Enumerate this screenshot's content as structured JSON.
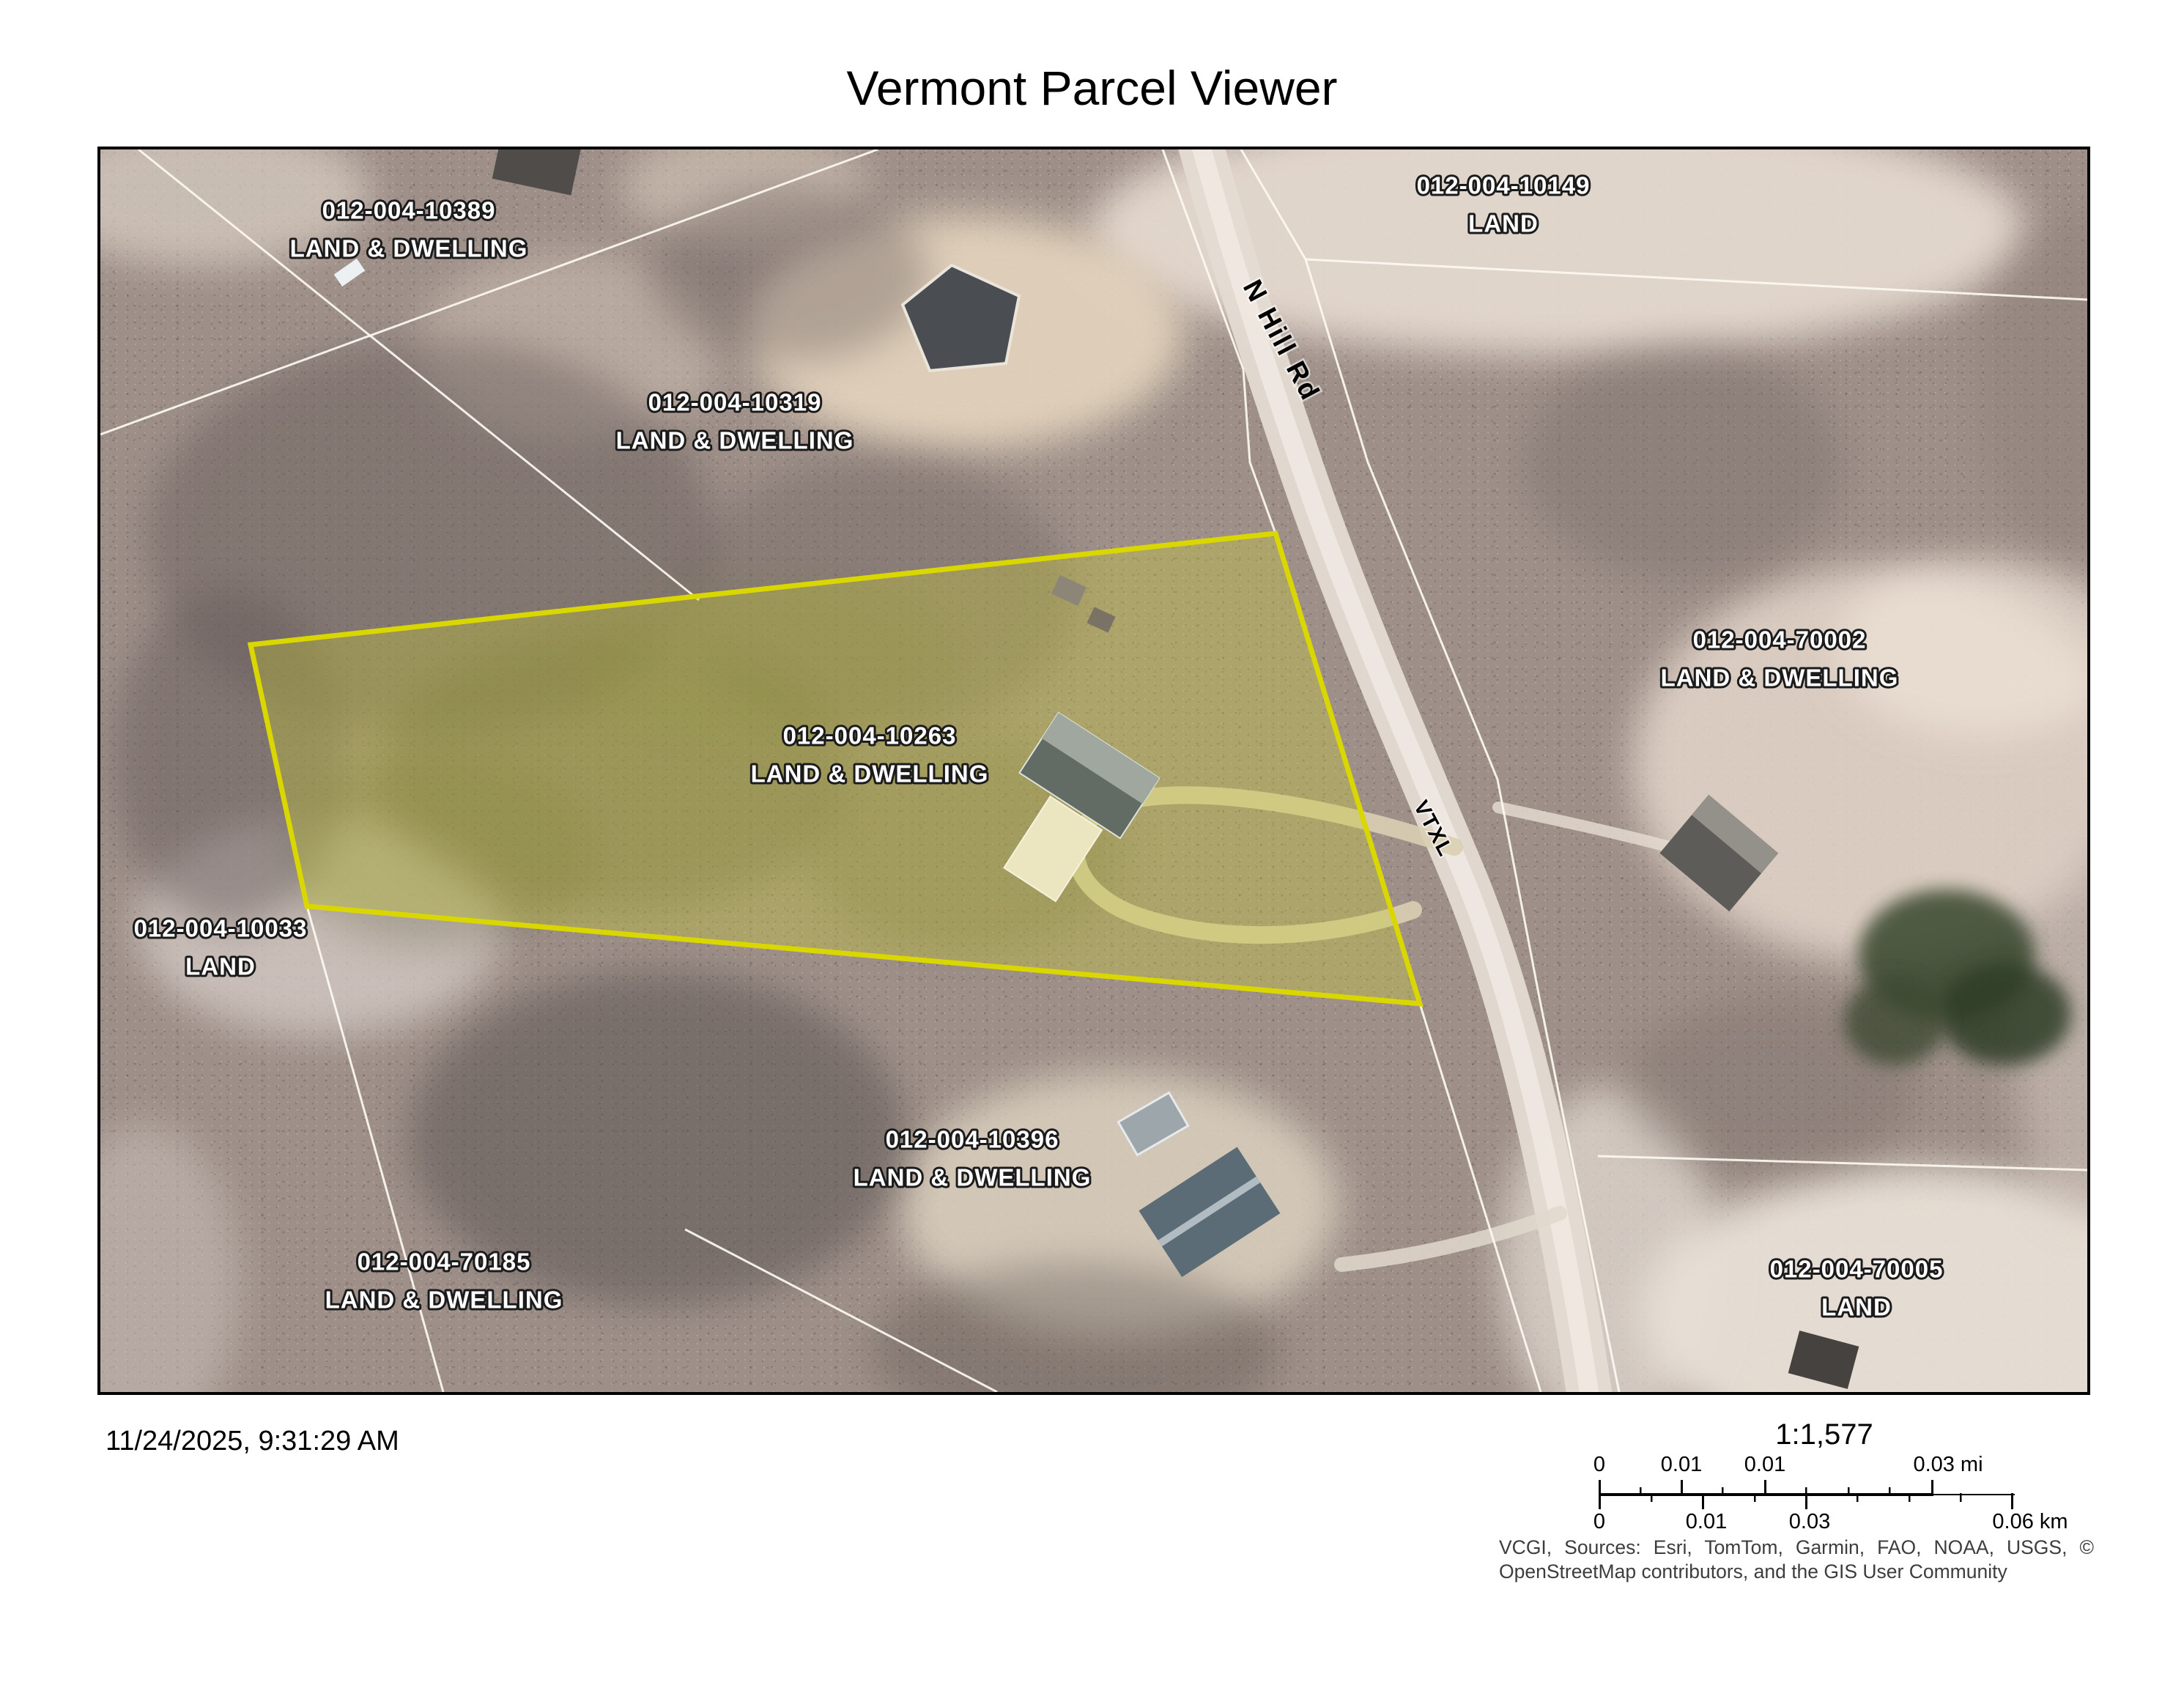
{
  "title": "Vermont Parcel Viewer",
  "map": {
    "highlight_color": "#d9d600",
    "road_label": "N Hill Rd",
    "easement_label": "VTXL",
    "parcels": [
      {
        "id": "012-004-10389",
        "type": "LAND & DWELLING"
      },
      {
        "id": "012-004-10319",
        "type": "LAND & DWELLING"
      },
      {
        "id": "012-004-10149",
        "type": "LAND"
      },
      {
        "id": "012-004-70002",
        "type": "LAND & DWELLING"
      },
      {
        "id": "012-004-10263",
        "type": "LAND & DWELLING",
        "highlighted": true
      },
      {
        "id": "012-004-10033",
        "type": "LAND"
      },
      {
        "id": "012-004-10396",
        "type": "LAND & DWELLING"
      },
      {
        "id": "012-004-70185",
        "type": "LAND & DWELLING"
      },
      {
        "id": "012-004-70005",
        "type": "LAND"
      }
    ]
  },
  "footer": {
    "timestamp": "11/24/2025, 9:31:29 AM",
    "scale_text": "1:1,577",
    "scalebar": {
      "mi_labels": [
        "0",
        "0.01",
        "0.01",
        "0.03 mi"
      ],
      "km_labels": [
        "0",
        "0.01",
        "0.03",
        "0.06 km"
      ]
    },
    "attribution_line1": "VCGI, Sources: Esri, TomTom, Garmin, FAO, NOAA, USGS, ©",
    "attribution_line2": "OpenStreetMap contributors, and the GIS User Community"
  }
}
